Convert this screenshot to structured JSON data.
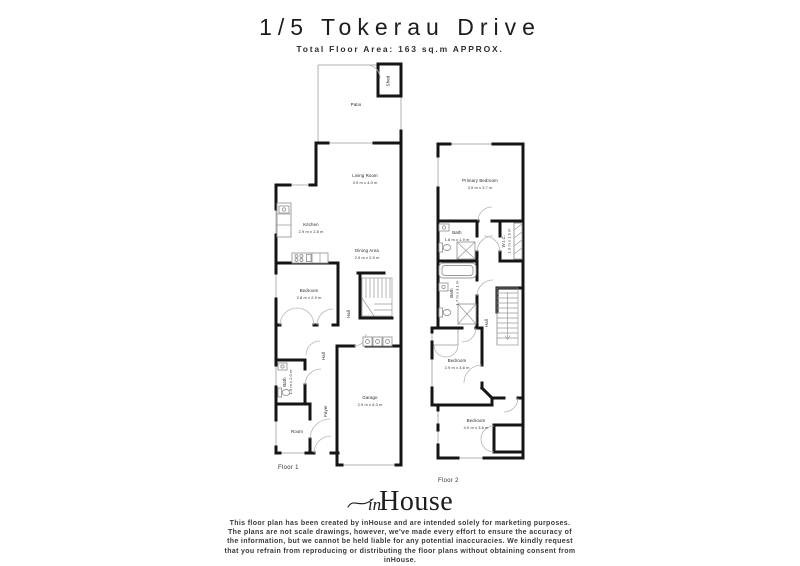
{
  "header": {
    "title": "1/5 Tokerau Drive",
    "subtitle": "Total Floor Area: 163 sq.m APPROX."
  },
  "floor1": {
    "label": "Floor 1",
    "rooms": {
      "shed": {
        "name": "Shed"
      },
      "patio": {
        "name": "Patio"
      },
      "living": {
        "name": "Living Room",
        "dims": "3.9 m x 4.0 m"
      },
      "kitchen": {
        "name": "Kitchen",
        "dims": "2.9 m x 2.8 m"
      },
      "dining": {
        "name": "Dining Area",
        "dims": "2.9 m x 2.9 m"
      },
      "bedroom": {
        "name": "Bedroom",
        "dims": "2.8 m x 2.9 m"
      },
      "hall_upper": {
        "name": "Hall"
      },
      "hall_lower": {
        "name": "Hall"
      },
      "bath": {
        "name": "Bath",
        "dims": "1.9 m x 2.0 m"
      },
      "garage": {
        "name": "Garage",
        "dims": "2.9 m x 6.3 m"
      },
      "foyer": {
        "name": "Foyer"
      },
      "room": {
        "name": "Room"
      }
    }
  },
  "floor2": {
    "label": "Floor 2",
    "rooms": {
      "primary": {
        "name": "Primary Bedroom",
        "dims": "3.9 m x 3.7 m"
      },
      "bath_ensuite": {
        "name": "Bath",
        "dims": "1.8 m x 1.9 m"
      },
      "wic": {
        "name": "W.I.C.",
        "dims": "1.0 m x 1.9 m"
      },
      "bath_main": {
        "name": "Bath",
        "dims": "1.7 m x 3.1 m"
      },
      "hall": {
        "name": "Hall"
      },
      "bedroom_mid": {
        "name": "Bedroom",
        "dims": "2.9 m x 3.6 m"
      },
      "bedroom_rear": {
        "name": "Bedroom",
        "dims": "4.0 m x 3.6 m"
      }
    }
  },
  "logo": {
    "script": "in",
    "serif": "House"
  },
  "footer": {
    "disclaimer": "This floor plan has been created by inHouse and are intended solely for marketing purposes. The plans are not scale drawings, however, we've made every effort to ensure the accuracy of the information, but we cannot be held liable for any potential inaccuracies. We kindly request that you refrain from reproducing or distributing the floor plans without obtaining consent from inHouse."
  },
  "colors": {
    "wall": "#151515",
    "thin_line": "#b0b0b0",
    "label_text": "#1d1d1d"
  }
}
